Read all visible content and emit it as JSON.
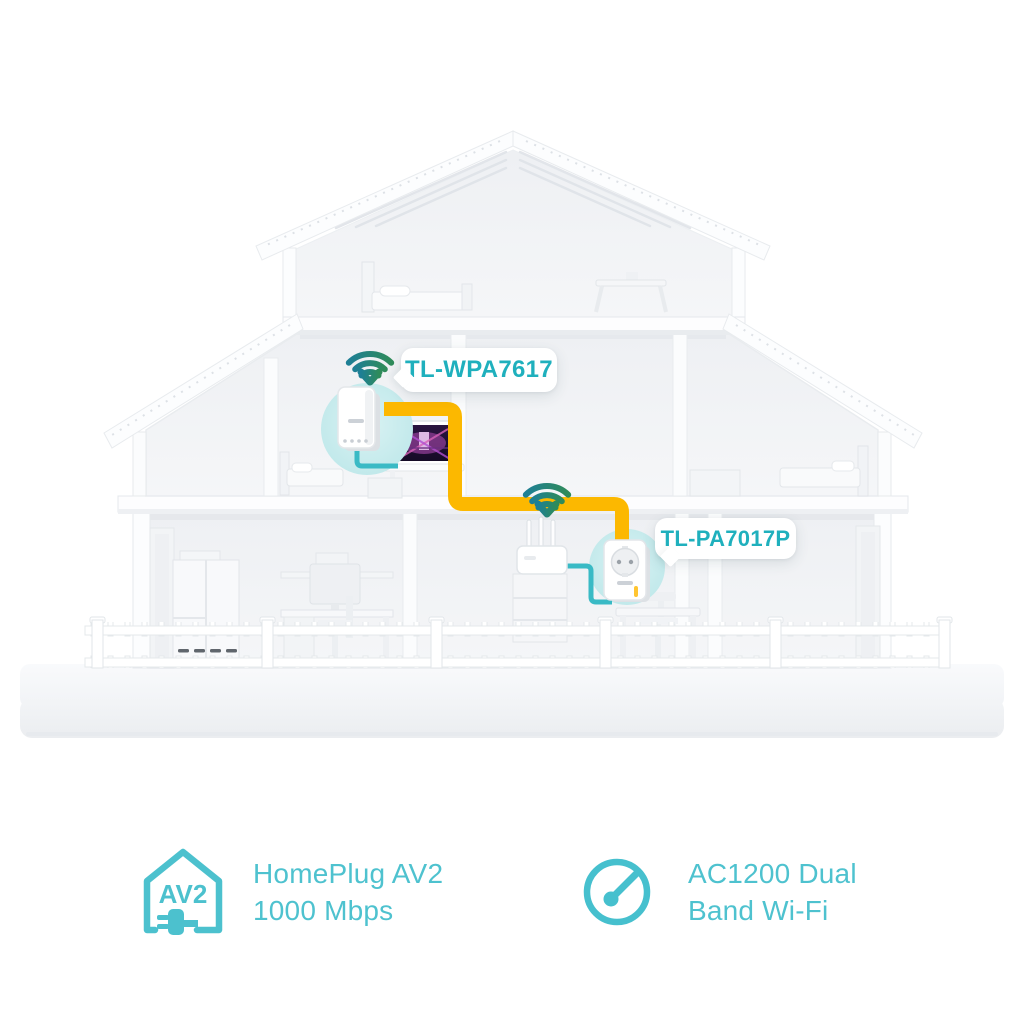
{
  "diagram": {
    "devices": [
      {
        "id": "wifi-extender",
        "label": "TL-WPA7617"
      },
      {
        "id": "powerline-adapter",
        "label": "TL-PA7017P"
      }
    ]
  },
  "features": [
    {
      "icon": "homeplug-av2-house-plug-icon",
      "icon_text": "AV2",
      "line1": "HomePlug AV2",
      "line2": "1000 Mbps"
    },
    {
      "icon": "speedometer-icon",
      "line1": "AC1200 Dual",
      "line2": "Band Wi-Fi"
    }
  ],
  "colors": {
    "brand_teal": "#1fb0bd",
    "feature_teal": "#4ec2cf",
    "cable_yellow": "#fcb800",
    "ethernet_teal": "#39bac5",
    "wifi_gradient_start": "#1e7f95",
    "wifi_gradient_end": "#2f8b5a",
    "device_halo": "#c8eaed"
  }
}
